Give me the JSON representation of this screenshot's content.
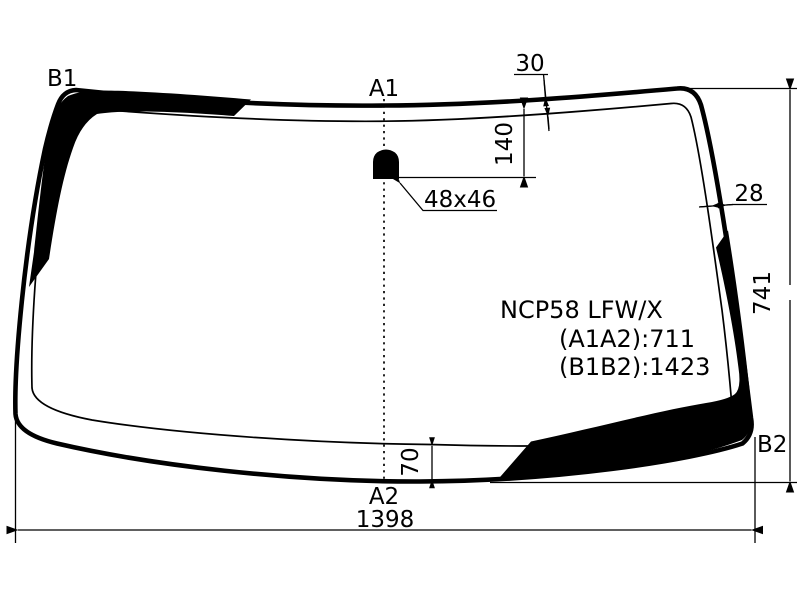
{
  "diagram": {
    "background_color": "#ffffff",
    "line_color": "#000000",
    "part_code": "NCP58 LFW/X",
    "spec_a1a2": "(A1A2):711",
    "spec_b1b2": "(B1B2):1423",
    "labels": {
      "top_left": "B1",
      "top_center": "A1",
      "bottom_center": "A2",
      "bottom_right": "B2"
    },
    "dims": {
      "top_band_width": "30",
      "mount_offset": "140",
      "side_band_width": "28",
      "glass_height": "741",
      "bottom_band_width": "70",
      "glass_width": "1398",
      "mount_size": "48x46"
    }
  }
}
